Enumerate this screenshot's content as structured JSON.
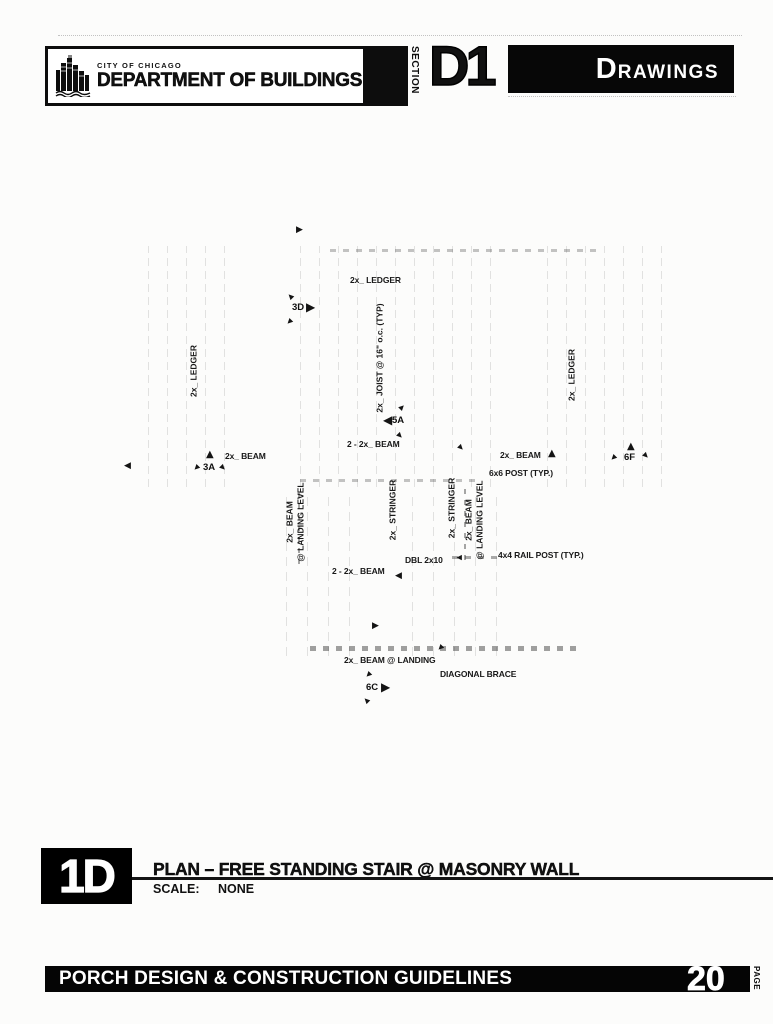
{
  "header": {
    "agency_small": "CITY OF CHICAGO",
    "agency_large": "DEPARTMENT OF BUILDINGS",
    "section_label": "SECTION",
    "section_code": "D1",
    "section_title": "DRAWINGS"
  },
  "icons": {
    "triangle_up": "▲",
    "triangle_right": "▶",
    "triangle_left": "◀"
  },
  "drawing": {
    "labels": {
      "ledger_top": "2x_ LEDGER",
      "ledger_left": "2x_ LEDGER",
      "ledger_right": "2x_ LEDGER",
      "joist": "2x_ JOIST @ 16\" o.c. (TYP)",
      "beam_upper": "2 - 2x_ BEAM",
      "beam_left": "2x_ BEAM",
      "beam_right": "2x_ BEAM",
      "post": "6x6 POST (TYP.)",
      "beam_landing_left": "2x_ BEAM\n@ LANDING LEVEL",
      "beam_landing_right": "2x_ BEAM\n@ LANDING LEVEL",
      "stringer_left": "2x_ STRINGER",
      "stringer_right": "2x_ STRINGER",
      "dbl": "DBL 2x10",
      "rail_post": "4x4 RAIL POST (TYP.)",
      "beam_lower": "2 - 2x_ BEAM",
      "beam_at_landing": "2x_ BEAM @ LANDING",
      "diagonal_brace": "DIAGONAL BRACE"
    },
    "markers": {
      "m3D": "3D",
      "m5A": "5A",
      "m3A": "3A",
      "m6F": "6F",
      "m6C": "6C"
    }
  },
  "title_block": {
    "figure_code": "1D",
    "title": "PLAN – FREE STANDING STAIR @ MASONRY WALL",
    "scale_label": "SCALE:",
    "scale_value": "NONE"
  },
  "footer": {
    "title": "PORCH DESIGN & CONSTRUCTION GUIDELINES",
    "page_number": "20",
    "page_label": "PAGE"
  }
}
